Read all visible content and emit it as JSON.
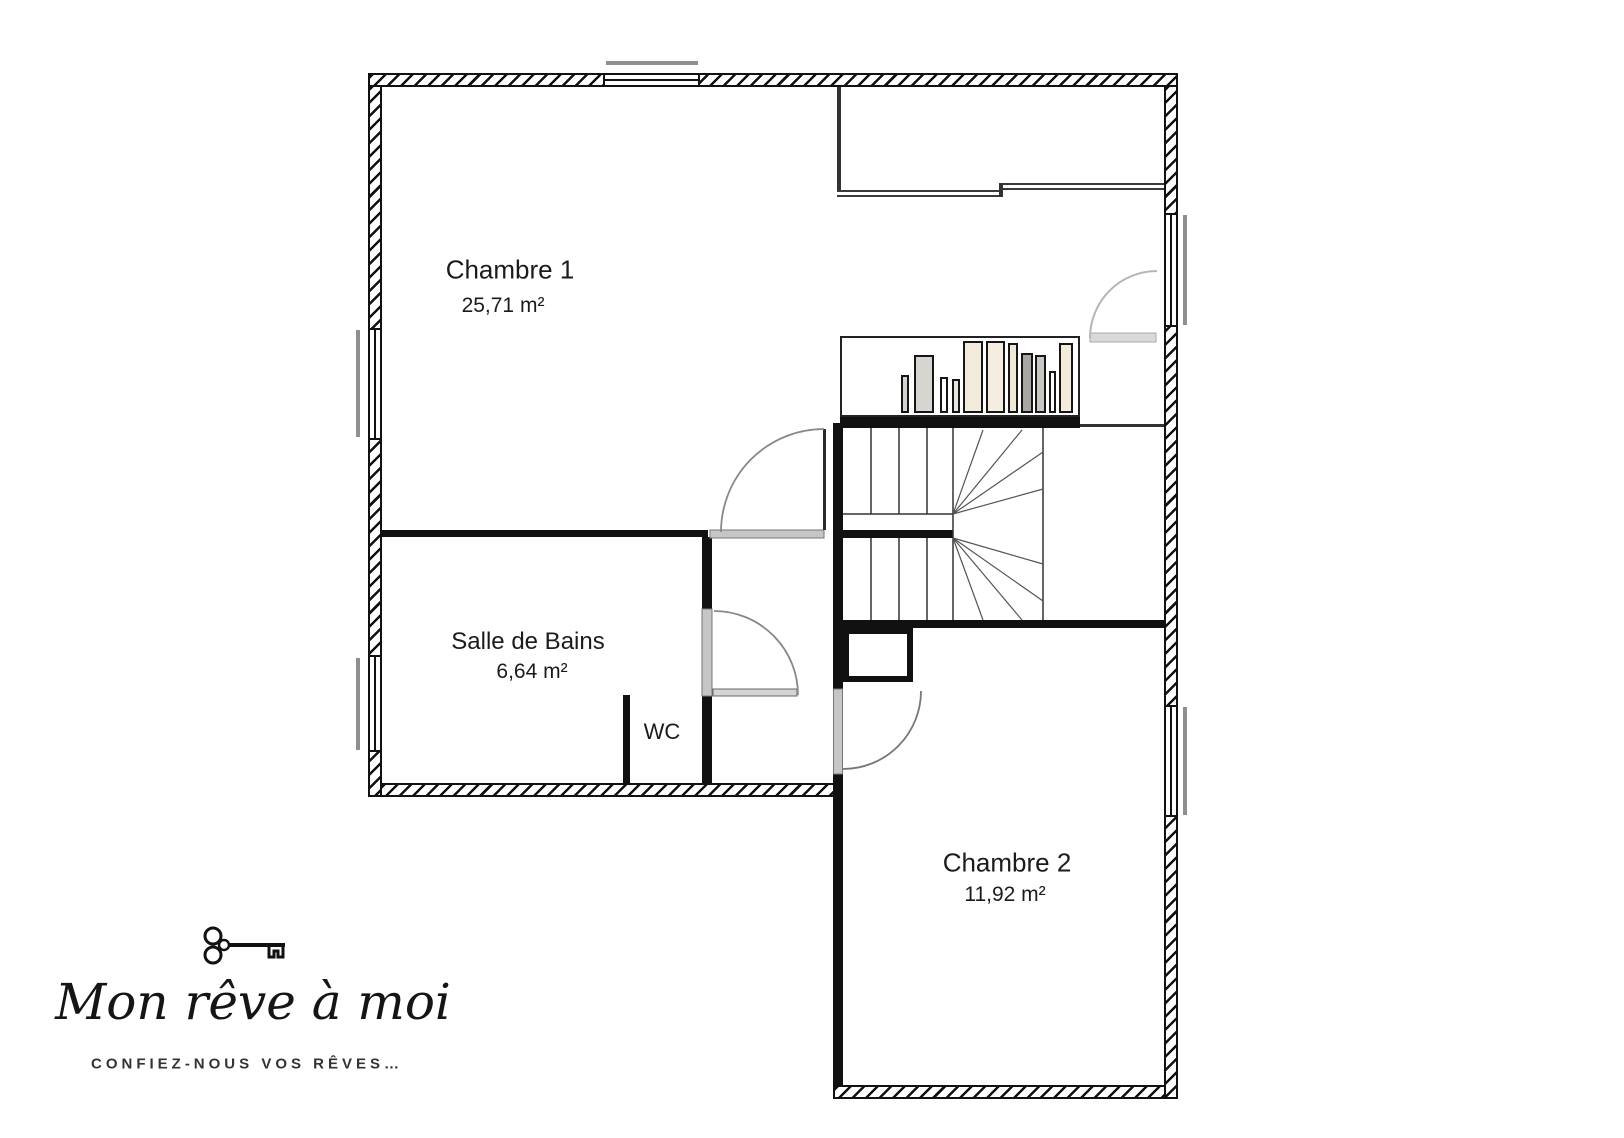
{
  "plan": {
    "rooms": [
      {
        "id": "chambre1",
        "name": "Chambre 1",
        "area": "25,71 m²"
      },
      {
        "id": "salle_de_bains",
        "name": "Salle de Bains",
        "area": "6,64 m²"
      },
      {
        "id": "wc",
        "name": "WC",
        "area": ""
      },
      {
        "id": "chambre2",
        "name": "Chambre 2",
        "area": "11,92 m²"
      }
    ]
  },
  "logo": {
    "icon": "key-icon",
    "brand": "Mon rêve à moi",
    "tagline": "CONFIEZ-NOUS VOS RÊVES…"
  },
  "colors": {
    "wall": "#111111",
    "door_gray": "#c6c6c6",
    "sill_gray": "#8f8f8f",
    "book_beige": "#f2ebdc",
    "book_gray": "#a9a5a1"
  }
}
